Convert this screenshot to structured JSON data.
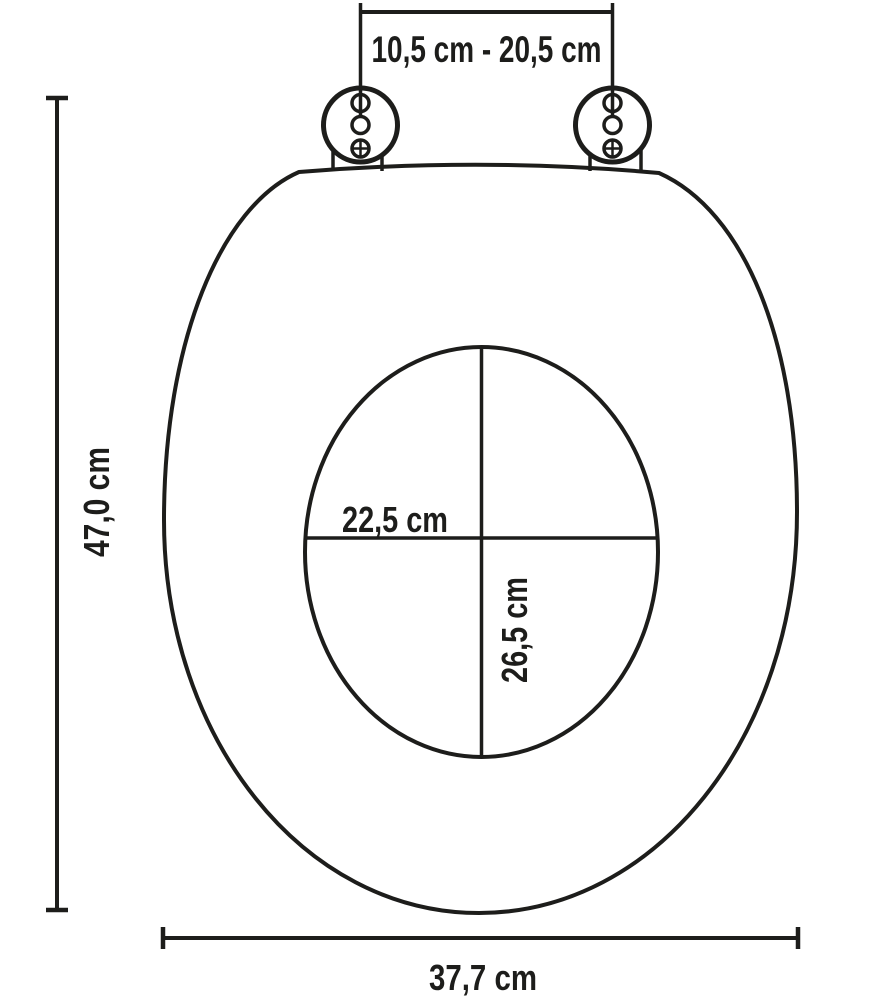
{
  "page": {
    "background": "#ffffff"
  },
  "diagram": {
    "subject": "toilet-seat-dimension-drawing",
    "line_color": "#1d1d1b",
    "labels": {
      "hinge_distance": "10,5 cm - 20,5 cm",
      "overall_height": "47,0 cm",
      "inner_width": "22,5 cm",
      "inner_depth": "26,5 cm",
      "overall_width": "37,7 cm"
    },
    "measurements": {
      "hinge_distance_cm_min": "10,5",
      "hinge_distance_cm_max": "20,5",
      "overall_height_cm": "47,0",
      "inner_width_cm": "22,5",
      "inner_depth_cm": "26,5",
      "overall_width_cm": "37,7"
    }
  }
}
